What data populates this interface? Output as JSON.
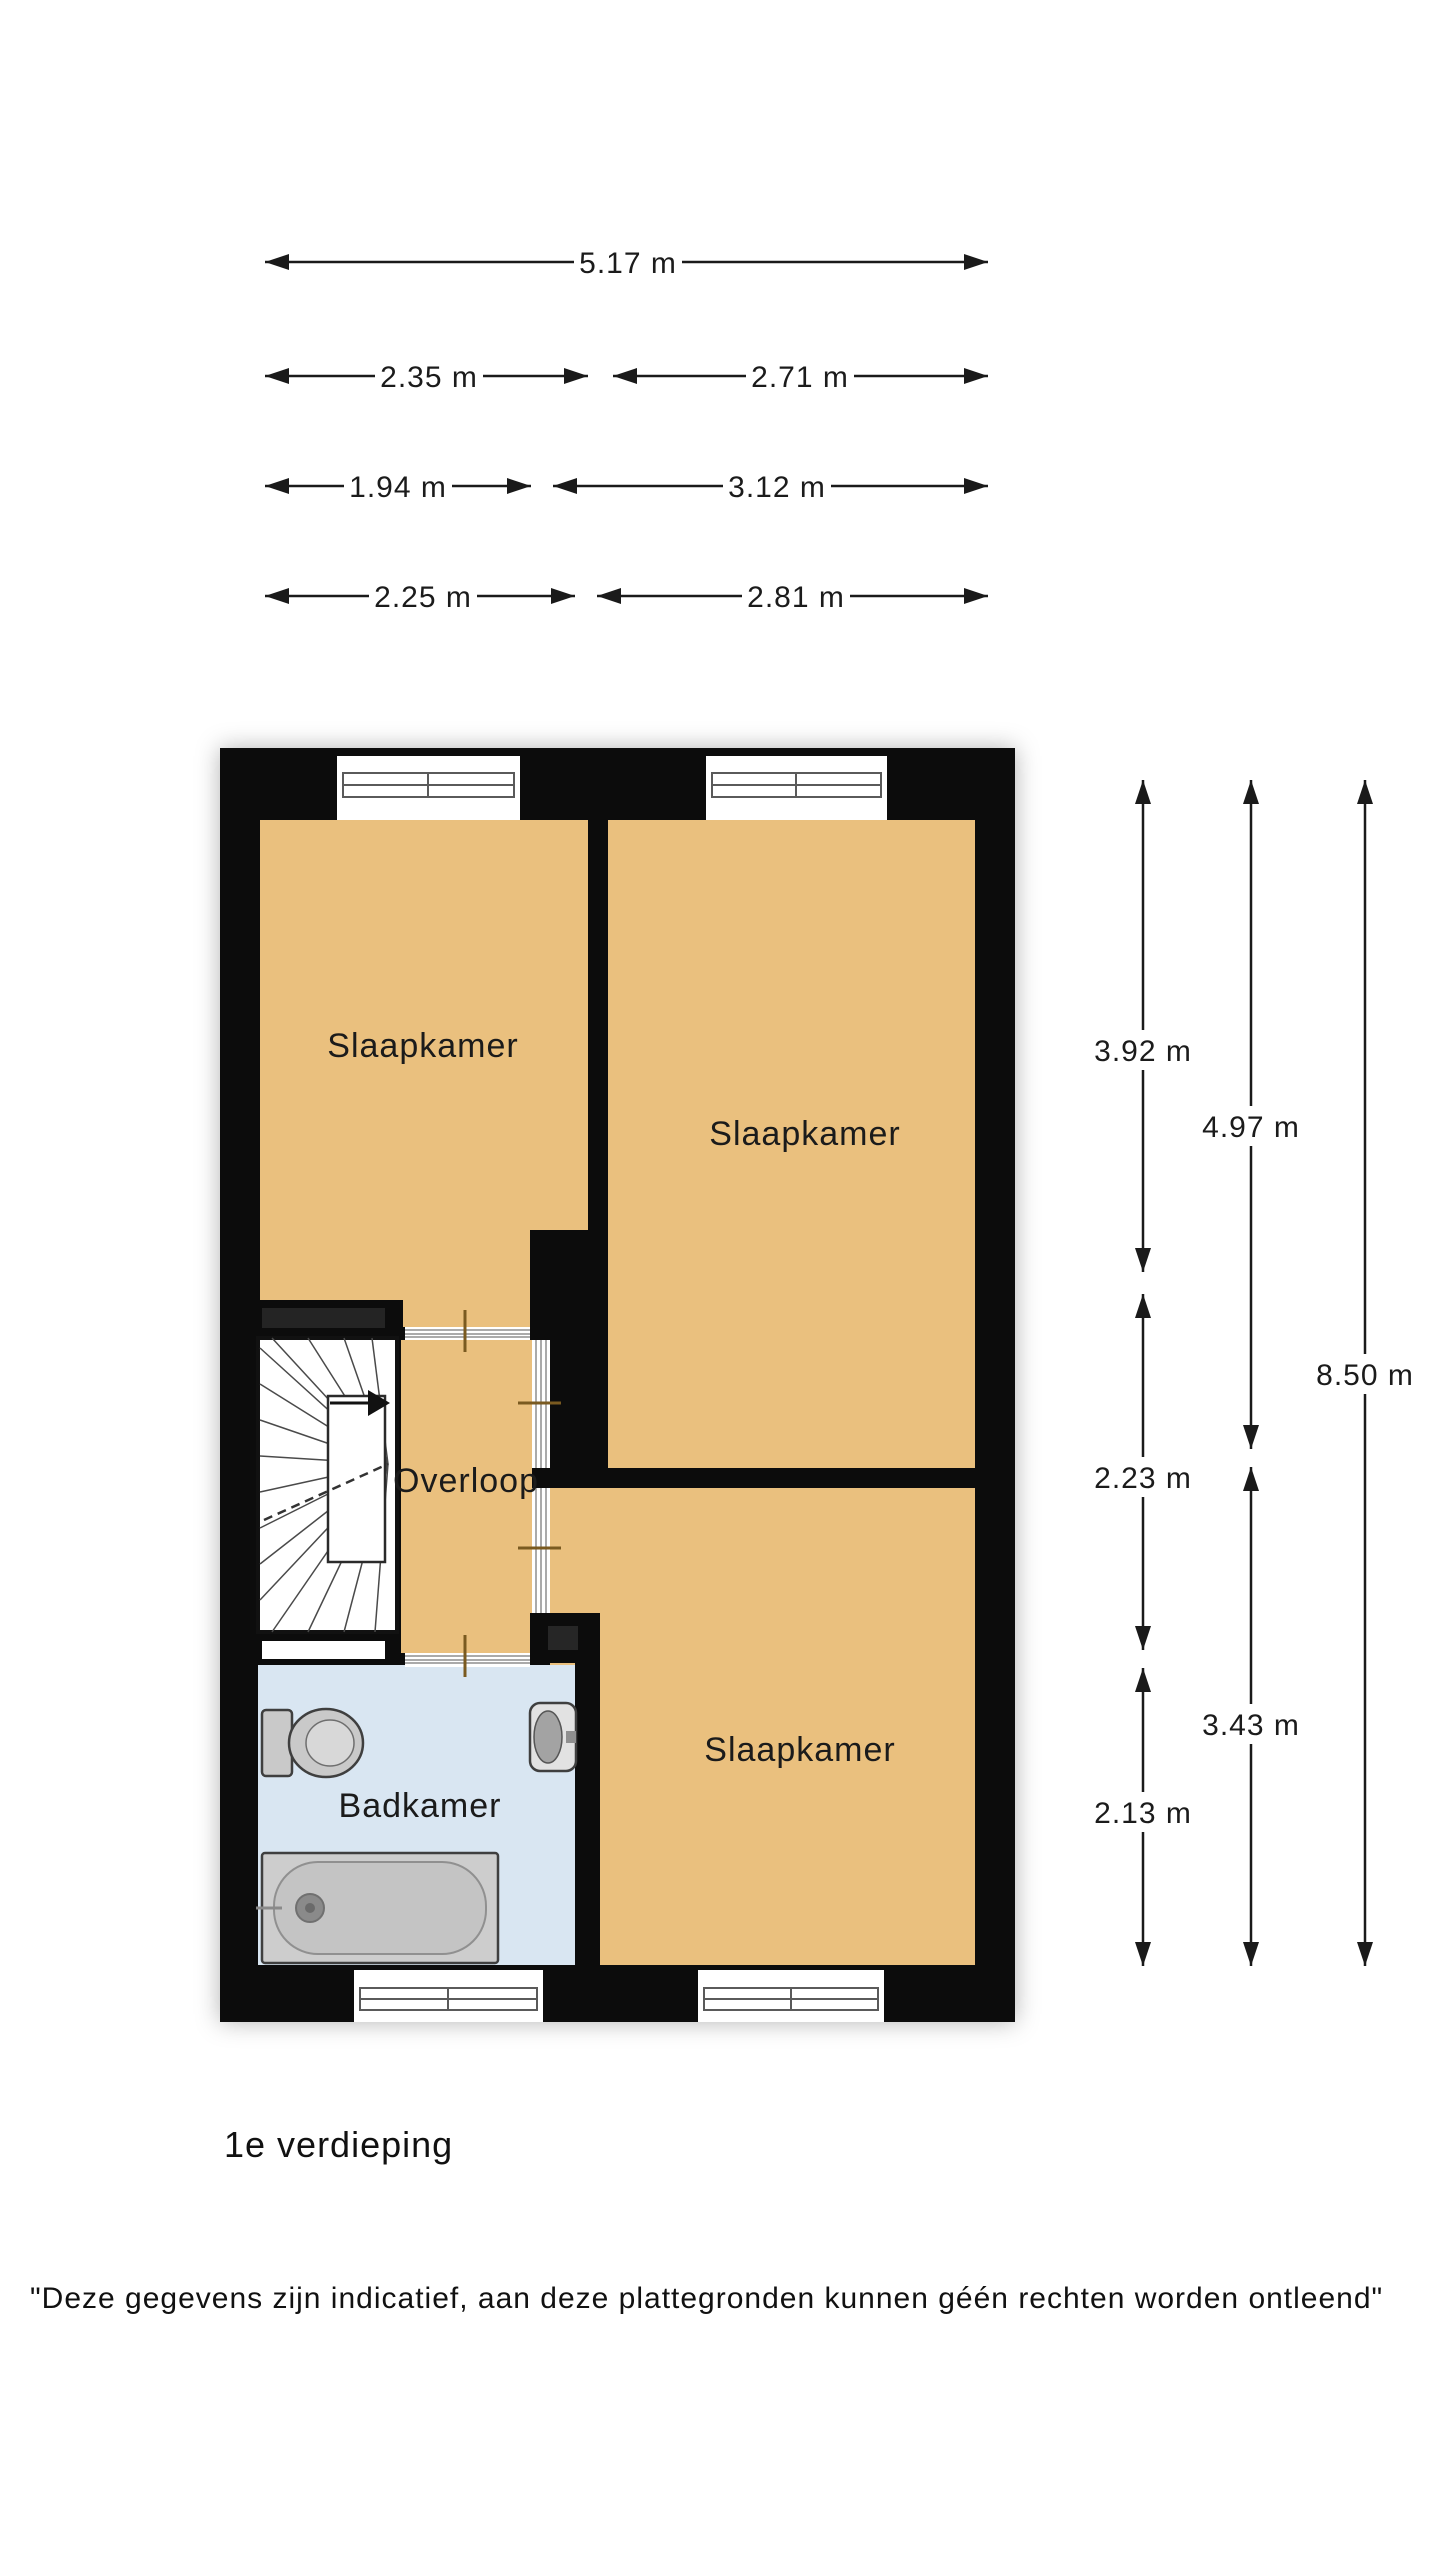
{
  "dims": {
    "w_total": "5.17 m",
    "w_r2_left": "2.35 m",
    "w_r2_right": "2.71 m",
    "w_r3_left": "1.94 m",
    "w_r3_right": "3.12 m",
    "w_r4_left": "2.25 m",
    "w_r4_right": "2.81 m",
    "h_c1_top": "3.92 m",
    "h_c1_mid": "2.23 m",
    "h_c1_bot": "2.13 m",
    "h_c2_top": "4.97 m",
    "h_c2_bot": "3.43 m",
    "h_total": "8.50 m"
  },
  "rooms": {
    "bedroom_top_left": "Slaapkamer",
    "bedroom_top_right": "Slaapkamer",
    "bedroom_bottom": "Slaapkamer",
    "landing": "Overloop",
    "bathroom": "Badkamer"
  },
  "floor_label": "1e verdieping",
  "disclaimer": "\"Deze gegevens zijn indicatief, aan deze plattegronden kunnen géén rechten worden ontleend\"",
  "colors": {
    "room_fill": "#eac07e",
    "bathroom_fill": "#d9e6f2",
    "wall": "#0c0c0c",
    "dimension_line": "#1a1a1a"
  }
}
